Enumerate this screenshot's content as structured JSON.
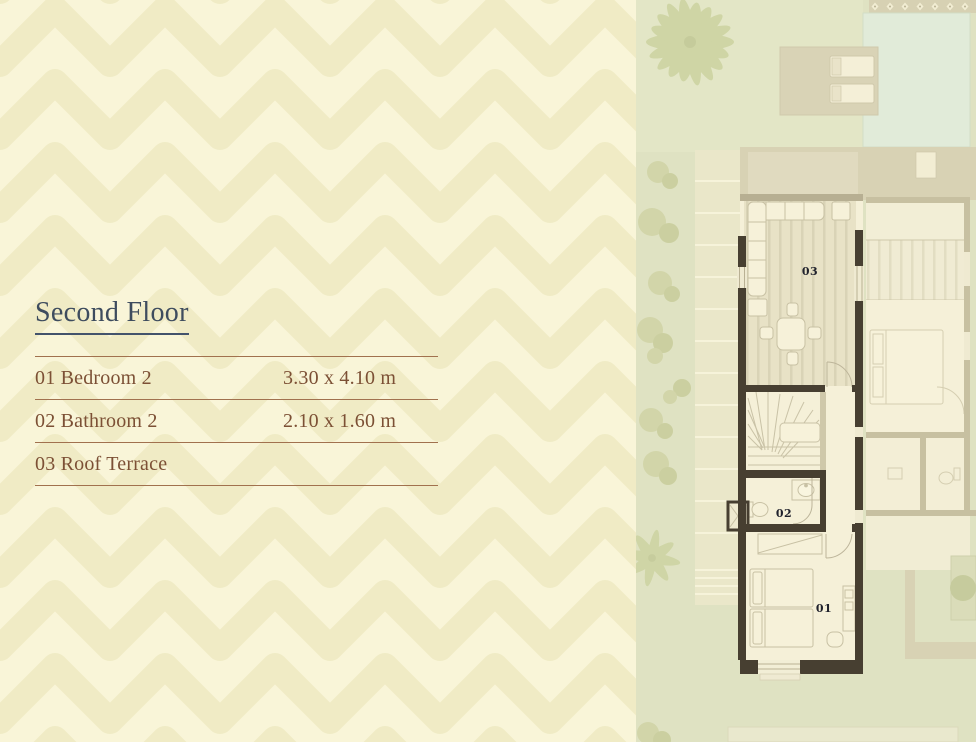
{
  "title": "Second Floor",
  "legend": {
    "rows": [
      {
        "label": "01 Bedroom 2",
        "dims": "3.30 x 4.10 m"
      },
      {
        "label": "02 Bathroom 2",
        "dims": "2.10 x 1.60 m"
      },
      {
        "label": "03 Roof Terrace",
        "dims": ""
      }
    ]
  },
  "plan": {
    "room_labels": {
      "terrace": "03",
      "bathroom": "02",
      "bedroom": "01"
    }
  },
  "colors": {
    "heading": "#3e4c5e",
    "legend_text": "#7c5035",
    "legend_line": "#a1714e",
    "wall_dark": "#473f31",
    "wall_faded": "#c7c0a1",
    "plan_label": "#20222c",
    "grass": "#dfe2c2",
    "pool": "#e1ebd9"
  }
}
